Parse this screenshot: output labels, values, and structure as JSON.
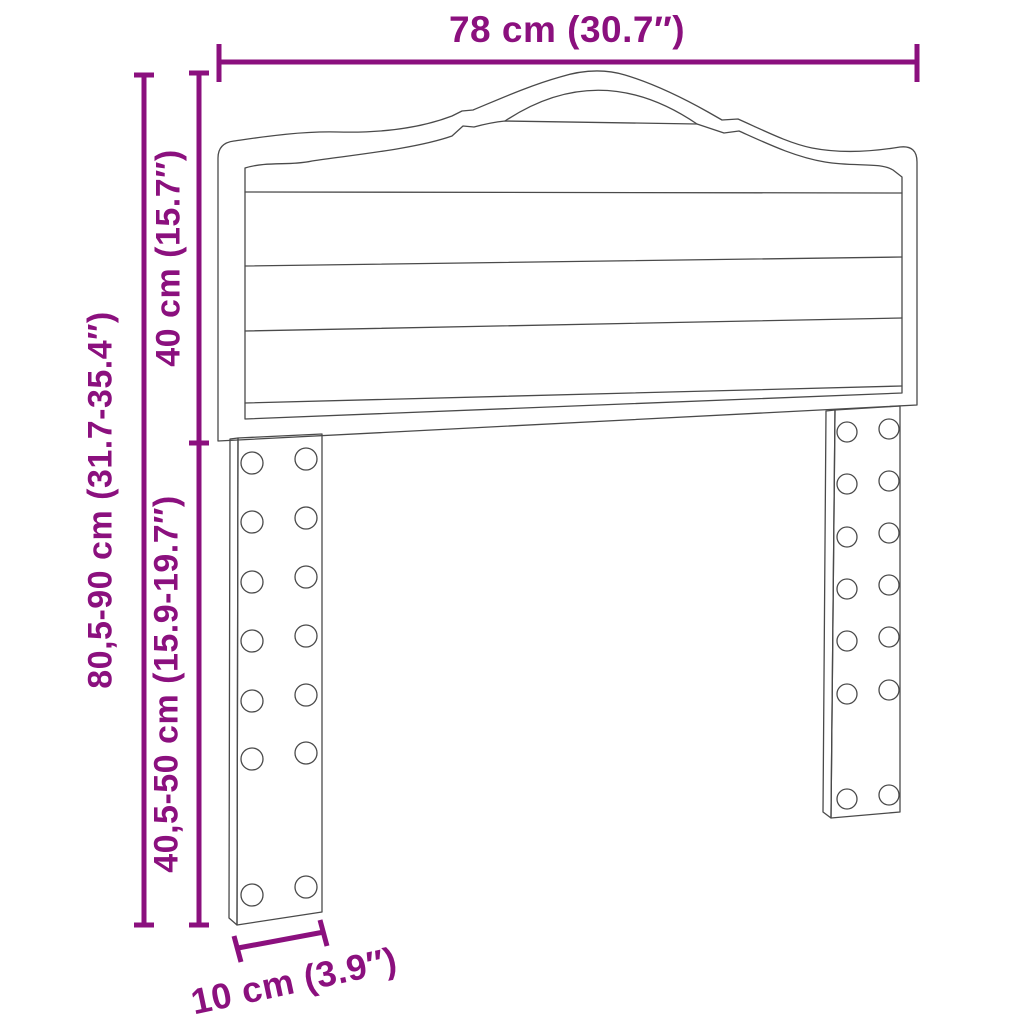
{
  "figure": {
    "type": "product-dimension-diagram",
    "subject": "headboard-with-legs",
    "colors": {
      "dimension": "#8B107E",
      "outline": "#4a4a4a",
      "background": "#ffffff"
    },
    "dimensions": {
      "width": {
        "label": "78 cm (30.7″)",
        "orientation": "horizontal-top"
      },
      "total_height": {
        "label": "80,5-90 cm (31.7-35.4″)",
        "orientation": "vertical-left-outer"
      },
      "panel_height": {
        "label": "40 cm (15.7″)",
        "orientation": "vertical-left-inner-top"
      },
      "leg_height": {
        "label": "40,5-50 cm (15.9-19.7″)",
        "orientation": "vertical-left-inner-bottom"
      },
      "leg_width": {
        "label": "10 cm (3.9″)",
        "orientation": "slanted-bottom"
      }
    }
  }
}
